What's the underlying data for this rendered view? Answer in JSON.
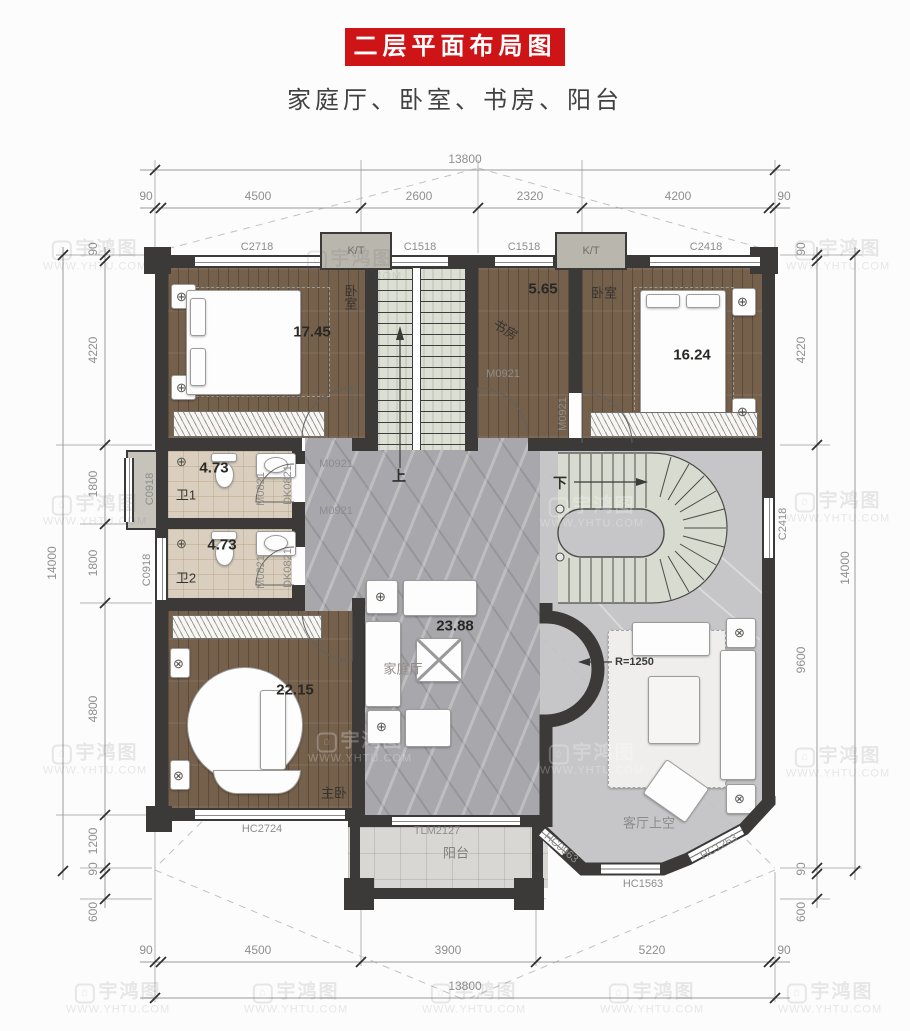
{
  "colors": {
    "banner_red": "#ce1417",
    "wall": "#3b3a38",
    "wood_floor": "#75604c",
    "marble_floor": "#a8a8ac",
    "void_floor": "#c6c6c8",
    "bath_tile": "#dacfbe",
    "dim_text": "#8f8f8f"
  },
  "title": {
    "banner": "二层平面布局图",
    "subtitle": "家庭厅、卧室、书房、阳台"
  },
  "watermark": {
    "brand": "宇鸿图",
    "url": "WWW.YHTU.COM"
  },
  "dims": {
    "top": {
      "overall": "13800",
      "s": [
        "90",
        "4500",
        "2600",
        "2320",
        "4200",
        "90"
      ]
    },
    "bottom": {
      "overall": "13800",
      "s": [
        "90",
        "4500",
        "3900",
        "5220",
        "90"
      ]
    },
    "left": {
      "overall": "14000",
      "s": [
        "90",
        "4220",
        "1800",
        "1800",
        "4800",
        "1200",
        "90",
        "600"
      ]
    },
    "right": {
      "overall": "14000",
      "s": [
        "90",
        "4220",
        "9600",
        "90",
        "600"
      ]
    }
  },
  "rooms": {
    "bedroom1": {
      "name": "卧室",
      "area": "17.45"
    },
    "study": {
      "name": "书房",
      "area": "5.65"
    },
    "bedroom2": {
      "name": "卧室",
      "area": "16.24"
    },
    "bath1": {
      "name": "卫1",
      "area": "4.73"
    },
    "bath2": {
      "name": "卫2",
      "area": "4.73"
    },
    "master": {
      "name": "主卧",
      "area": "22.15"
    },
    "family": {
      "name": "家庭厅",
      "area": "23.88"
    },
    "balcony": {
      "name": "阳台"
    },
    "void": {
      "name": "客厅上空"
    }
  },
  "codes": {
    "c2718": "C2718",
    "c1518": "C1518",
    "c2418": "C2418",
    "c0918": "C0918",
    "m0821": "M0821",
    "dk0821": "DK0821",
    "m0921": "M0921",
    "hc2724": "HC2724",
    "tlm2127": "TLM2127",
    "hc0963": "HC0963",
    "hc1563": "HC1563",
    "hc1263": "HC1263",
    "kt": "K/T"
  },
  "stairs": {
    "up": "上",
    "down": "下",
    "radius": "R=1250"
  }
}
